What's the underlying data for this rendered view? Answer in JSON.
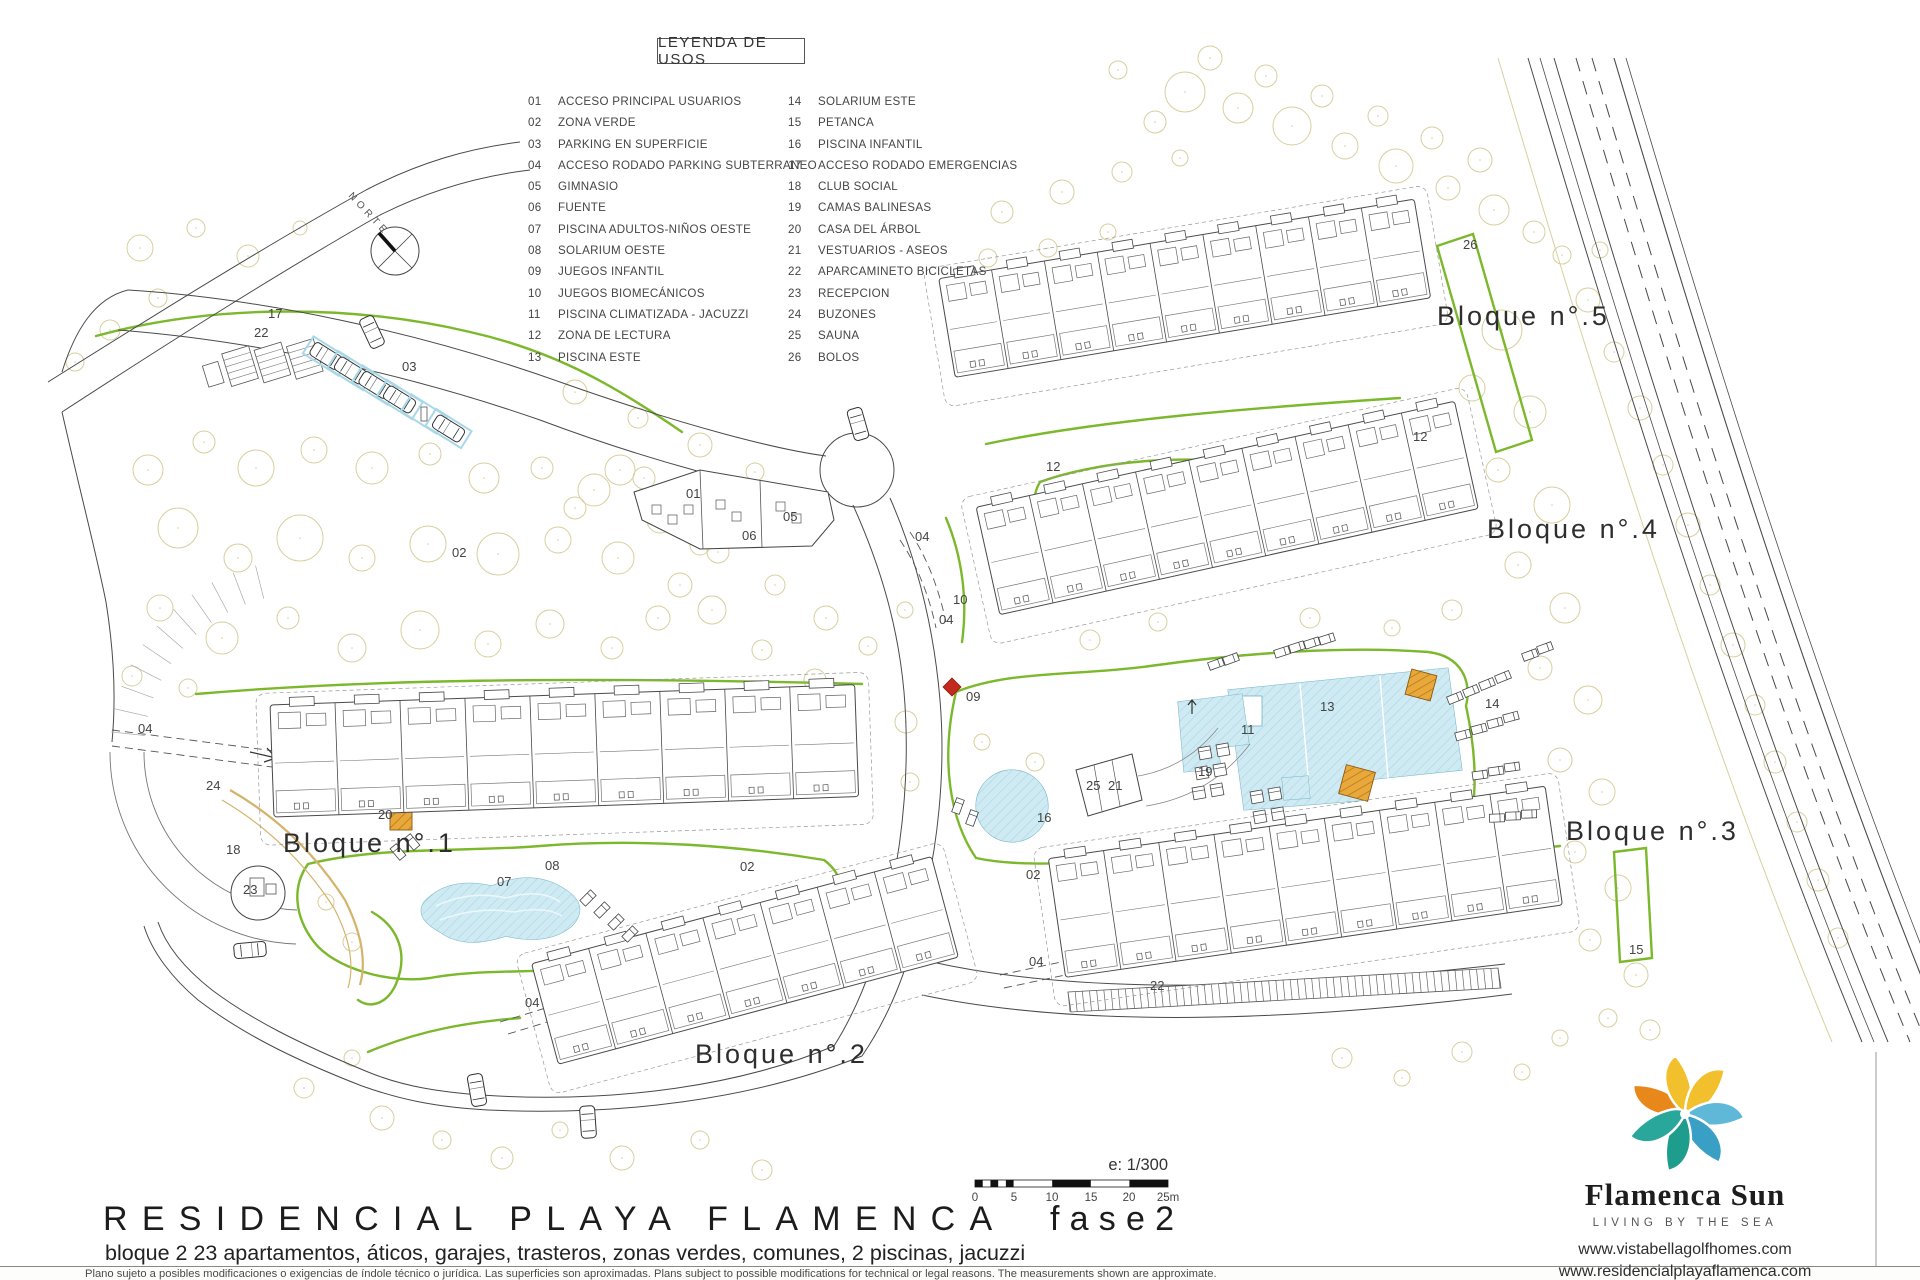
{
  "legend": {
    "title": "LEYENDA DE USOS",
    "items": [
      {
        "num": "01",
        "label": "ACCESO PRINCIPAL USUARIOS"
      },
      {
        "num": "02",
        "label": "ZONA VERDE"
      },
      {
        "num": "03",
        "label": "PARKING EN SUPERFICIE"
      },
      {
        "num": "04",
        "label": "ACCESO RODADO PARKING SUBTERRANEO"
      },
      {
        "num": "05",
        "label": "GIMNASIO"
      },
      {
        "num": "06",
        "label": "FUENTE"
      },
      {
        "num": "07",
        "label": "PISCINA ADULTOS-NIÑOS OESTE"
      },
      {
        "num": "08",
        "label": "SOLARIUM OESTE"
      },
      {
        "num": "09",
        "label": "JUEGOS INFANTIL"
      },
      {
        "num": "10",
        "label": "JUEGOS BIOMECÁNICOS"
      },
      {
        "num": "11",
        "label": "PISCINA CLIMATIZADA - JACUZZI"
      },
      {
        "num": "12",
        "label": "ZONA DE LECTURA"
      },
      {
        "num": "13",
        "label": "PISCINA ESTE"
      },
      {
        "num": "14",
        "label": "SOLARIUM ESTE"
      },
      {
        "num": "15",
        "label": "PETANCA"
      },
      {
        "num": "16",
        "label": "PISCINA INFANTIL"
      },
      {
        "num": "17",
        "label": "ACCESO RODADO EMERGENCIAS"
      },
      {
        "num": "18",
        "label": "CLUB SOCIAL"
      },
      {
        "num": "19",
        "label": "CAMAS BALINESAS"
      },
      {
        "num": "20",
        "label": "CASA DEL ÁRBOL"
      },
      {
        "num": "21",
        "label": "VESTUARIOS - ASEOS"
      },
      {
        "num": "22",
        "label": "APARCAMINETO BICICLETAS"
      },
      {
        "num": "23",
        "label": "RECEPCION"
      },
      {
        "num": "24",
        "label": "BUZONES"
      },
      {
        "num": "25",
        "label": "SAUNA"
      },
      {
        "num": "26",
        "label": "BOLOS"
      }
    ]
  },
  "plan": {
    "north_label": "NORTE",
    "block_labels": [
      {
        "text": "Bloque n°.1",
        "x": 283,
        "y": 852
      },
      {
        "text": "Bloque n°.2",
        "x": 695,
        "y": 1063
      },
      {
        "text": "Bloque n°.3",
        "x": 1566,
        "y": 840
      },
      {
        "text": "Bloque n°.4",
        "x": 1487,
        "y": 538
      },
      {
        "text": "Bloque n°.5",
        "x": 1437,
        "y": 325
      }
    ],
    "markers": [
      {
        "n": "17",
        "x": 268,
        "y": 318
      },
      {
        "n": "22",
        "x": 254,
        "y": 337
      },
      {
        "n": "03",
        "x": 402,
        "y": 371
      },
      {
        "n": "02",
        "x": 452,
        "y": 557
      },
      {
        "n": "01",
        "x": 686,
        "y": 498
      },
      {
        "n": "05",
        "x": 783,
        "y": 521
      },
      {
        "n": "06",
        "x": 742,
        "y": 540
      },
      {
        "n": "04",
        "x": 915,
        "y": 541
      },
      {
        "n": "10",
        "x": 953,
        "y": 604
      },
      {
        "n": "04",
        "x": 939,
        "y": 624
      },
      {
        "n": "12",
        "x": 1046,
        "y": 471
      },
      {
        "n": "12",
        "x": 1413,
        "y": 441
      },
      {
        "n": "26",
        "x": 1463,
        "y": 249
      },
      {
        "n": "09",
        "x": 966,
        "y": 701
      },
      {
        "n": "11",
        "x": 1241,
        "y": 734
      },
      {
        "n": "13",
        "x": 1320,
        "y": 711
      },
      {
        "n": "19",
        "x": 1198,
        "y": 776
      },
      {
        "n": "25",
        "x": 1086,
        "y": 790
      },
      {
        "n": "21",
        "x": 1108,
        "y": 790
      },
      {
        "n": "16",
        "x": 1037,
        "y": 822
      },
      {
        "n": "14",
        "x": 1485,
        "y": 708
      },
      {
        "n": "02",
        "x": 740,
        "y": 871
      },
      {
        "n": "02",
        "x": 1026,
        "y": 879
      },
      {
        "n": "07",
        "x": 497,
        "y": 886
      },
      {
        "n": "08",
        "x": 545,
        "y": 870
      },
      {
        "n": "20",
        "x": 378,
        "y": 819
      },
      {
        "n": "18",
        "x": 226,
        "y": 854
      },
      {
        "n": "24",
        "x": 206,
        "y": 790
      },
      {
        "n": "23",
        "x": 243,
        "y": 894
      },
      {
        "n": "04",
        "x": 525,
        "y": 1007
      },
      {
        "n": "04",
        "x": 1029,
        "y": 966
      },
      {
        "n": "22",
        "x": 1150,
        "y": 990
      },
      {
        "n": "15",
        "x": 1629,
        "y": 954
      },
      {
        "n": "04",
        "x": 138,
        "y": 733
      }
    ],
    "scale": {
      "label": "e: 1/300",
      "ticks": [
        {
          "t": "0",
          "x": 975
        },
        {
          "t": "5",
          "x": 1014
        },
        {
          "t": "10",
          "x": 1052
        },
        {
          "t": "15",
          "x": 1091
        },
        {
          "t": "20",
          "x": 1129
        },
        {
          "t": "25m",
          "x": 1168
        }
      ]
    }
  },
  "title_block": {
    "title": "RESIDENCIAL PLAYA FLAMENCA",
    "phase": "fase2",
    "subtitle": "bloque 2   23 apartamentos, áticos, garajes, trasteros, zonas verdes, comunes, 2 piscinas, jacuzzi"
  },
  "footer": {
    "disclaimer": "Plano sujeto a posibles modificaciones o exigencias de índole técnico o jurídica. Las superficies son aproximadas. Plans subject to possible modifications for technical or legal reasons. The measurements shown are approximate."
  },
  "brand": {
    "name": "Flamenca Sun",
    "tagline": "LIVING BY THE SEA",
    "urls": [
      "www.vistabellagolfhomes.com",
      "www.residencialplayaflamenca.com"
    ]
  },
  "colors": {
    "green": "#7cb82c",
    "water_fill": "#cfeaf2",
    "water_line": "#6fb3c6",
    "tree_line": "#d8cf9d",
    "orange": "#e9a83c",
    "red": "#c4291d",
    "stall_blue": "#a8d8e8",
    "ink": "#4a4a4a",
    "logo_orange": "#E8881B",
    "logo_yellow": "#F2C02C",
    "logo_teal": "#1E9C8C",
    "logo_blue": "#5FB8D8"
  }
}
